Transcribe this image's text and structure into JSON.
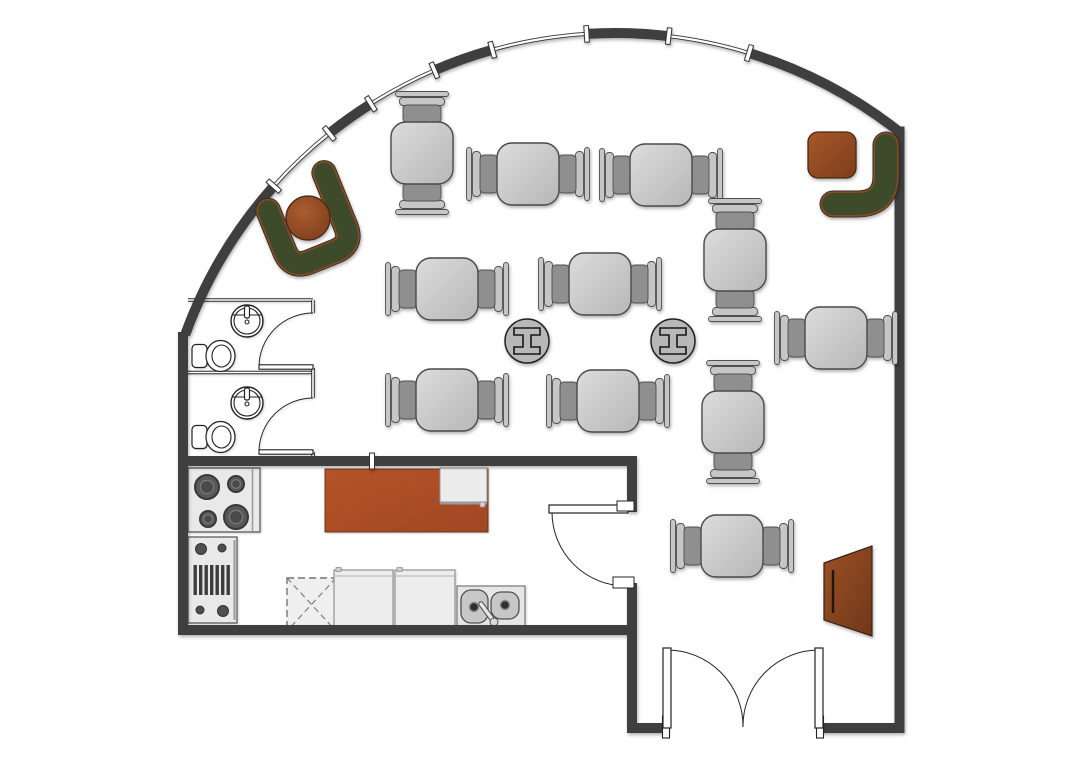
{
  "app": {
    "name": "cafe-floor-plan"
  },
  "canvas": {
    "width": 1089,
    "height": 782,
    "bg": "#ffffff"
  },
  "palette": {
    "wall": "#3f3f3f",
    "wall_width": 10,
    "thin_wall": "#2a2a2a",
    "fixture_stroke": "#222222",
    "table_stroke": "#4a4a4a",
    "table_fill_a": "#d9d9d9",
    "table_fill_b": "#b9b9b9",
    "chair_seat": "#8f8f8f",
    "chair_back": "#c6c6c6",
    "column_fill": "#b8b8b8",
    "sofa_green": "#3e4b2a",
    "sofa_trim": "#8c4a21",
    "sofa_outline": "#2d2d2d",
    "wood_light": "#a8592e",
    "wood_dark": "#7c3d1b",
    "island_a": "#b5532a",
    "island_b": "#a04722",
    "appliance_fill": "#e9e9e9",
    "appliance_stroke": "#5e5e5e",
    "cabinet_fill": "#ededed",
    "window_line": "#333333"
  },
  "arc_wall": {
    "cx": 615.3,
    "cy": 490.4,
    "r": 457.4,
    "start_deg": 199.9,
    "end_deg": 308.4,
    "junction_degs": [
      221.7,
      231.3,
      237.7,
      246.7,
      254.4,
      266.4,
      276.7,
      287.0
    ],
    "first_segment": "wall",
    "mullion": {
      "w": 4.6,
      "h": 16.5
    }
  },
  "straight_walls": [
    {
      "name": "right-wall",
      "x1": 899.5,
      "y1": 126.5,
      "x2": 899.5,
      "y2": 733
    },
    {
      "name": "bottom-wall-right",
      "x1": 904.5,
      "y1": 728,
      "x2": 820,
      "y2": 728
    },
    {
      "name": "bottom-wall-left",
      "x1": 668,
      "y1": 728,
      "x2": 627,
      "y2": 728
    },
    {
      "name": "vestibule-wall",
      "x1": 632,
      "y1": 733,
      "x2": 632,
      "y2": 583
    },
    {
      "name": "kitchen-east-wall",
      "x1": 632,
      "y1": 512,
      "x2": 632,
      "y2": 456
    },
    {
      "name": "kitchen-north-wall",
      "x1": 637,
      "y1": 461,
      "x2": 178,
      "y2": 461
    },
    {
      "name": "kitchen-south-wall",
      "x1": 178,
      "y1": 630,
      "x2": 637,
      "y2": 630
    },
    {
      "name": "west-wall",
      "x1": 183,
      "y1": 332,
      "x2": 183,
      "y2": 635
    }
  ],
  "wall_tick": {
    "x": 369.5,
    "y": 453,
    "w": 5,
    "h": 16
  },
  "bathrooms": {
    "left_x": 188,
    "right_x": 313,
    "top_y": 300,
    "divider_y": 372.5,
    "bottom_y": 461,
    "east_wall_segments": [
      [
        300,
        313
      ],
      [
        368,
        398
      ],
      [
        452,
        461
      ]
    ],
    "doors": [
      {
        "leaf_x1": 259,
        "leaf_x2": 313,
        "leaf_y": 367,
        "arc": "M 259 367 A 54 54 0 0 1 313 313"
      },
      {
        "leaf_x1": 259,
        "leaf_x2": 313,
        "leaf_y": 452,
        "arc": "M 259 452 A 54 54 0 0 1 313 398"
      }
    ],
    "sinks": [
      {
        "cx": 247,
        "cy": 321
      },
      {
        "cx": 247,
        "cy": 403
      }
    ],
    "toilets": [
      {
        "cx": 214,
        "cy": 356
      },
      {
        "cx": 214,
        "cy": 437
      }
    ]
  },
  "kitchen": {
    "stove": {
      "x": 188,
      "y": 468,
      "w": 72,
      "h": 64,
      "panel_x": 252.5,
      "burners": [
        {
          "cx": 207,
          "cy": 487,
          "r": 12
        },
        {
          "cx": 236,
          "cy": 484,
          "r": 8
        },
        {
          "cx": 208,
          "cy": 519,
          "r": 8
        },
        {
          "cx": 236,
          "cy": 517,
          "r": 12
        }
      ]
    },
    "grill": {
      "x": 188,
      "y": 537,
      "w": 49,
      "h": 86,
      "panel_x": 234.5,
      "knobs": [
        {
          "cx": 201,
          "cy": 549,
          "r": 5.5
        },
        {
          "cx": 222,
          "cy": 548,
          "r": 4
        },
        {
          "cx": 200,
          "cy": 610,
          "r": 4
        },
        {
          "cx": 223,
          "cy": 611,
          "r": 5.5
        }
      ],
      "slats": {
        "x": 193.5,
        "y": 565,
        "n": 7,
        "step": 5.5,
        "bw": 3.4,
        "bh": 30
      }
    },
    "island": {
      "x": 325,
      "y": 469,
      "w": 163,
      "h": 63
    },
    "island_board": {
      "x": 440,
      "y": 468,
      "w": 47,
      "h": 34,
      "line_y": 503.5,
      "knob": {
        "x": 480,
        "y": 502,
        "s": 5
      }
    },
    "dashed_unit": {
      "x": 287,
      "y": 578,
      "w": 49,
      "h": 53
    },
    "cabinets": [
      {
        "x": 334,
        "y": 570,
        "w": 59,
        "h": 60,
        "handle_x": 336
      },
      {
        "x": 395,
        "y": 570,
        "w": 60,
        "h": 60,
        "handle_x": 397
      }
    ],
    "sink_unit": {
      "x": 457,
      "y": 586,
      "w": 68,
      "h": 42,
      "basins": [
        {
          "x": 461,
          "y": 590,
          "w": 27,
          "h": 33
        },
        {
          "x": 491,
          "y": 592,
          "w": 28,
          "h": 27
        }
      ],
      "drains": [
        {
          "cx": 474,
          "cy": 607
        },
        {
          "cx": 505,
          "cy": 605
        }
      ],
      "faucet": {
        "x1": 481,
        "y1": 604,
        "x2": 493.5,
        "y2": 621,
        "knob": {
          "cx": 494,
          "cy": 622,
          "r": 4
        }
      }
    }
  },
  "doors": {
    "kitchen": {
      "leaf": {
        "x": 549,
        "y": 505,
        "w": 79,
        "h": 8
      },
      "arc": "M 552 512 A 74 74 0 0 0 626 586",
      "jambs": [
        {
          "x": 617,
          "y": 501,
          "w": 17,
          "h": 10
        },
        {
          "x": 613,
          "y": 577,
          "w": 21,
          "h": 11
        }
      ]
    },
    "entrance": {
      "leaves": [
        {
          "x": 663,
          "y": 648,
          "w": 8,
          "h": 80
        },
        {
          "x": 815,
          "y": 648,
          "w": 8,
          "h": 80
        }
      ],
      "arcs": [
        "M 667 650 A 76 76 0 0 1 743 727",
        "M 819 650 A 76 76 0 0 0 743 727"
      ],
      "jambs": [
        {
          "x": 662.5,
          "y": 716,
          "w": 7,
          "h": 22
        },
        {
          "x": 816.5,
          "y": 716,
          "w": 7,
          "h": 22
        }
      ]
    }
  },
  "tables": [
    {
      "x": 422,
      "y": 153,
      "o": "v"
    },
    {
      "x": 528,
      "y": 174,
      "o": "h"
    },
    {
      "x": 661,
      "y": 175,
      "o": "h"
    },
    {
      "x": 447,
      "y": 289,
      "o": "h"
    },
    {
      "x": 600,
      "y": 284,
      "o": "h"
    },
    {
      "x": 735,
      "y": 260,
      "o": "v"
    },
    {
      "x": 836,
      "y": 338,
      "o": "h"
    },
    {
      "x": 447,
      "y": 400,
      "o": "h"
    },
    {
      "x": 608,
      "y": 401,
      "o": "h"
    },
    {
      "x": 733,
      "y": 422,
      "o": "v"
    },
    {
      "x": 732,
      "y": 546,
      "o": "h"
    }
  ],
  "table_size": 62,
  "columns": {
    "r": 22,
    "items": [
      {
        "cx": 527,
        "cy": 341
      },
      {
        "cx": 673,
        "cy": 341
      }
    ]
  },
  "sofa_corner_left": {
    "cx": 310,
    "cy": 226,
    "rotate": -22,
    "band_w": 20.5,
    "path": "M -33 -30 L -33 14 Q -33 33 -14 33 L 14 33 Q 33 33 33 14 L 33 -44",
    "table": {
      "cx": 308,
      "cy": 218,
      "r": 22
    }
  },
  "sofa_corner_right": {
    "band_w": 22,
    "path": "M 886 145 L 886 176 Q 886 204 857 204 L 833 204",
    "table": {
      "x": 808,
      "y": 132,
      "w": 48,
      "h": 46,
      "rx": 10
    }
  },
  "host_stand": {
    "points": "824,563 872,546 872,636 824,620",
    "line": {
      "x1": 833,
      "y1": 570,
      "x2": 833,
      "y2": 613
    }
  }
}
